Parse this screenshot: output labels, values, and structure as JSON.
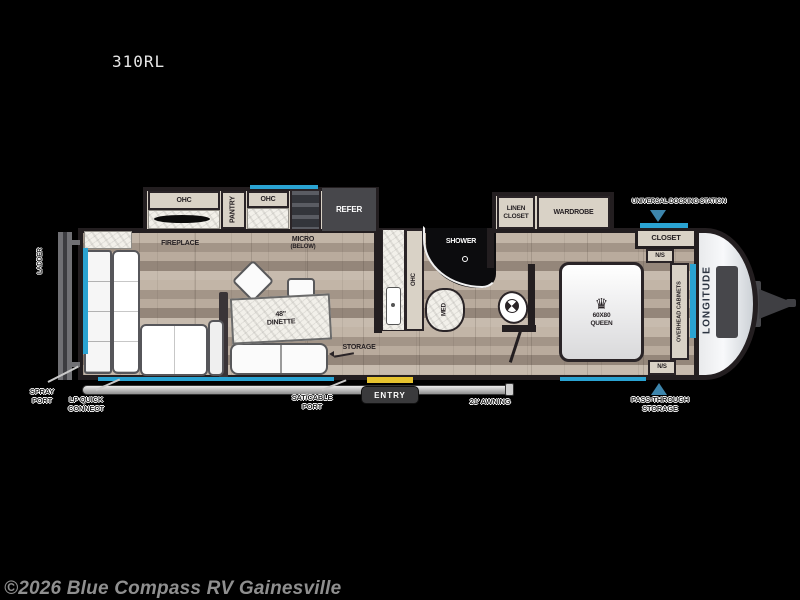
{
  "title": "310RL",
  "copyright": "©2026 Blue Compass RV Gainesville",
  "brand": "LONGITUDE",
  "colors": {
    "accent_blue": "#2aa3d2",
    "entry_yellow": "#e6c32f",
    "wall_dark": "#231e20"
  },
  "exterior": {
    "ladder": "LADDER",
    "spray_l1": "SPRAY",
    "spray_l2": "PORT",
    "lp_l1": "LP QUICK",
    "lp_l2": "CONNECT",
    "sat_l1": "SAT/CABLE",
    "sat_l2": "PORT",
    "awning": "21' AWNING",
    "entry": "ENTRY",
    "pass_l1": "PASS-THROUGH",
    "pass_l2": "STORAGE",
    "docking": "UNIVERSAL DOCKING STATION"
  },
  "kitchen": {
    "ohc1": "OHC",
    "pantry": "PANTRY",
    "ohc2": "OHC",
    "refer": "REFER",
    "fireplace": "FIREPLACE",
    "micro_l1": "MICRO",
    "micro_l2": "(BELOW)"
  },
  "living": {
    "dinette_l1": "48\"",
    "dinette_l2": "DINETTE",
    "storage": "STORAGE"
  },
  "bath": {
    "ohc": "OHC",
    "shower": "SHOWER",
    "med": "MED"
  },
  "bedroom": {
    "linen_l1": "LINEN",
    "linen_l2": "CLOSET",
    "wardrobe": "WARDROBE",
    "closet": "CLOSET",
    "ns": "N/S",
    "bed_size": "60X80",
    "bed_type": "QUEEN",
    "overhead": "OVERHEAD CABINETS",
    "crown_icon": "♛"
  }
}
